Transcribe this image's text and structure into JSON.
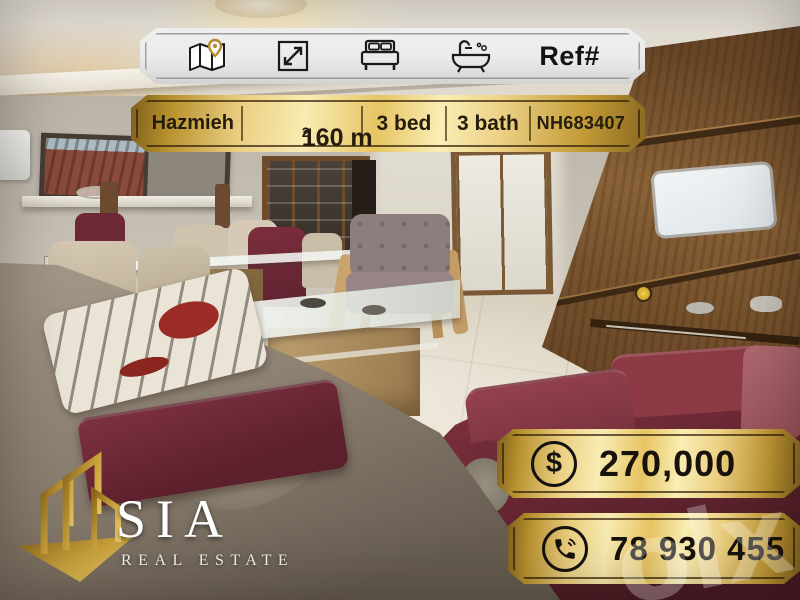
{
  "listing": {
    "location": "Hazmieh",
    "area_value": "160 m",
    "area_exponent": "2",
    "bedrooms": "3 bed",
    "bathrooms": "3 bath",
    "reference_label": "Ref#",
    "reference_code": "NH683407",
    "price": "270,000",
    "phone": "78 930 455"
  },
  "brand": {
    "name": "SIA",
    "tagline": "REAL ESTATE"
  },
  "watermark": {
    "text": "olx"
  },
  "icons": {
    "dollar_glyph": "$",
    "names": [
      "map-location-icon",
      "dimensions-icon",
      "bed-icon",
      "bath-icon",
      "dollar-icon",
      "phone-icon"
    ]
  },
  "colors": {
    "gold_bright": "#f8ecb2",
    "gold_deep": "#8a6a20",
    "banner_white": "#f2f2f2",
    "text_dark": "#1c150a",
    "maroon_sofa": "#6e2a37",
    "taupe_sofa": "#8a7e6f",
    "pin_gold": "#bd8f2e"
  }
}
